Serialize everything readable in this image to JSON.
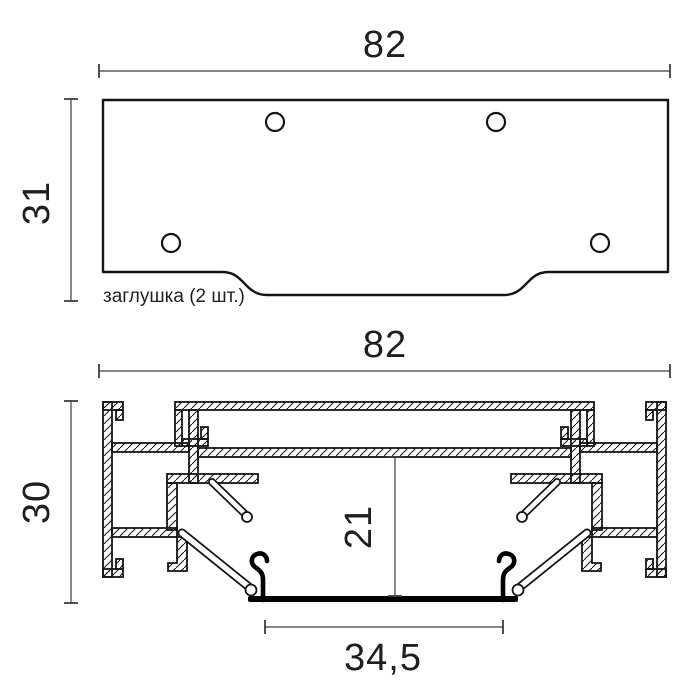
{
  "drawing": {
    "background_color": "#ffffff",
    "outline_color": "#141414",
    "dim_line_color": "#3c3c3c",
    "cover_color": "#000000",
    "end_cap_view": {
      "name": "end cap top view",
      "label": "заглушка (2 шт.)",
      "width_dim": "82",
      "height_dim": "31",
      "hole_count": "4"
    },
    "profile_view": {
      "name": "aluminium profile cross-section",
      "width_dim": "82",
      "height_dim": "30",
      "inner_height_dim": "21",
      "bottom_width_dim": "34,5"
    }
  }
}
